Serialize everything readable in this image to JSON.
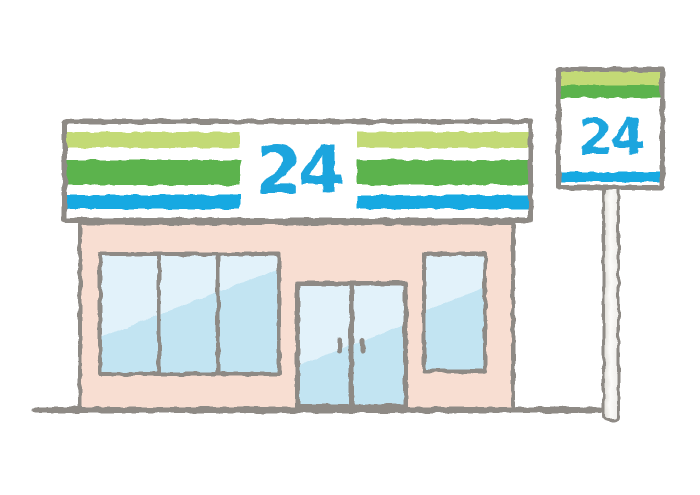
{
  "signs": {
    "canopy": {
      "text": "24"
    },
    "pole": {
      "text": "24"
    }
  },
  "colors": {
    "stripe_light_green": "#c3da76",
    "stripe_green": "#5cb34d",
    "stripe_blue": "#14a9e2",
    "numeral_blue": "#1ba5de",
    "wall_pink": "#f8ded2",
    "glass_blue": "#c2e4f2",
    "glass_highlight": "#e2f2fa",
    "outline_gray": "#8e8a85",
    "pole_fill": "#f1f0ed"
  }
}
